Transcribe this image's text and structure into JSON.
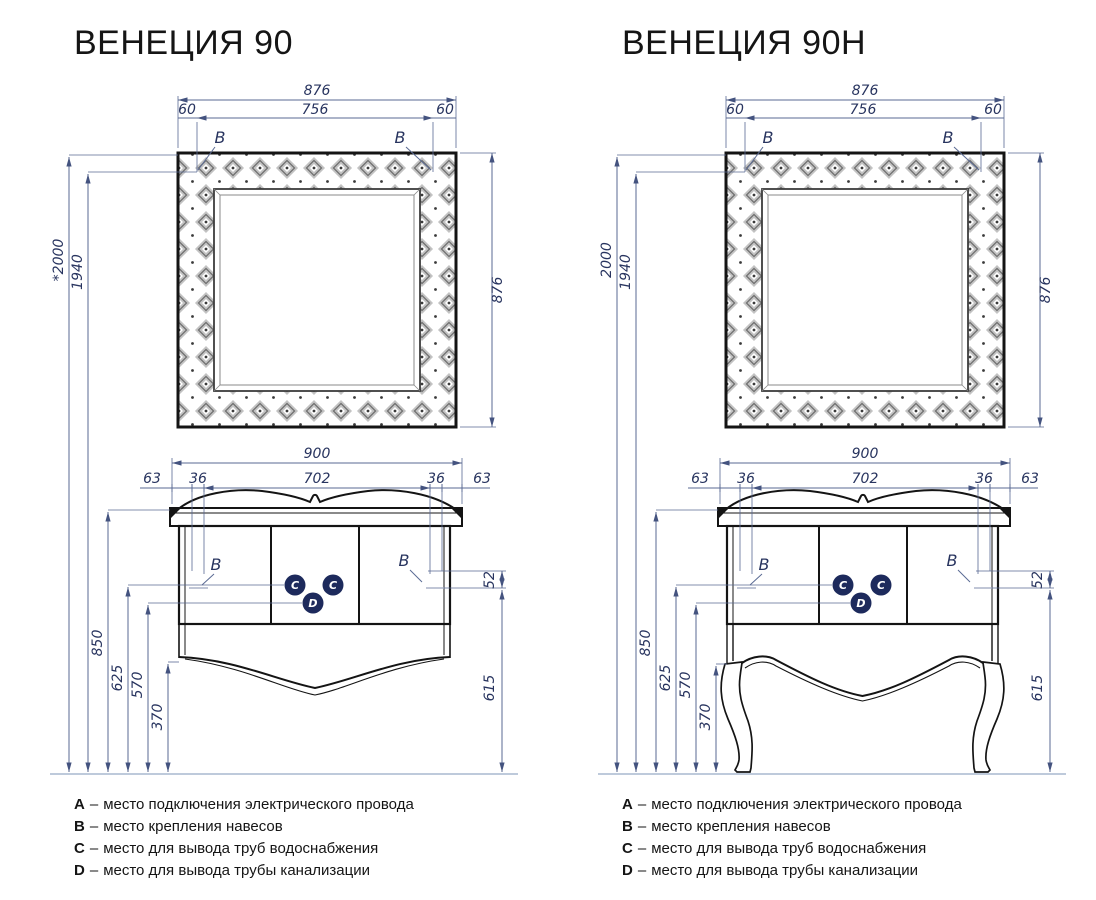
{
  "colors": {
    "line": "#141414",
    "dimension": "#5a6a93",
    "dim_text": "#28345f",
    "badge": "#1d2a5c",
    "floor": "#a9b8cf"
  },
  "legend": {
    "separator": "–",
    "items": [
      {
        "key": "A",
        "text": "место подключения электрического провода"
      },
      {
        "key": "B",
        "text": "место крепления навесов"
      },
      {
        "key": "C",
        "text": "место для вывода труб водоснабжения"
      },
      {
        "key": "D",
        "text": "место для вывода трубы канализации"
      }
    ]
  },
  "drawings": [
    {
      "title": "ВЕНЕЦИЯ 90",
      "marker_b": "B",
      "marker_c": "C",
      "marker_d": "D",
      "dims": {
        "mirror_width": "876",
        "mirror_trim_left": "60",
        "mirror_inner_width": "756",
        "mirror_trim_right": "60",
        "mirror_height": "876",
        "cabinet_width": "900",
        "edge_left": "63",
        "offset_left": "36",
        "door_span": "702",
        "offset_right": "36",
        "edge_right": "63",
        "total_height": "*2000",
        "mount_height": "1940",
        "counter_height": "850",
        "supply_height": "625",
        "drain_height": "570",
        "bottom_clearance": "370",
        "top_offset": "52",
        "side_clearance": "615"
      }
    },
    {
      "title": "ВЕНЕЦИЯ 90Н",
      "marker_b": "B",
      "marker_c": "C",
      "marker_d": "D",
      "dims": {
        "mirror_width": "876",
        "mirror_trim_left": "60",
        "mirror_inner_width": "756",
        "mirror_trim_right": "60",
        "mirror_height": "876",
        "cabinet_width": "900",
        "edge_left": "63",
        "offset_left": "36",
        "door_span": "702",
        "offset_right": "36",
        "edge_right": "63",
        "total_height": "2000",
        "mount_height": "1940",
        "counter_height": "850",
        "supply_height": "625",
        "drain_height": "570",
        "bottom_clearance": "370",
        "top_offset": "52",
        "side_clearance": "615"
      }
    }
  ]
}
